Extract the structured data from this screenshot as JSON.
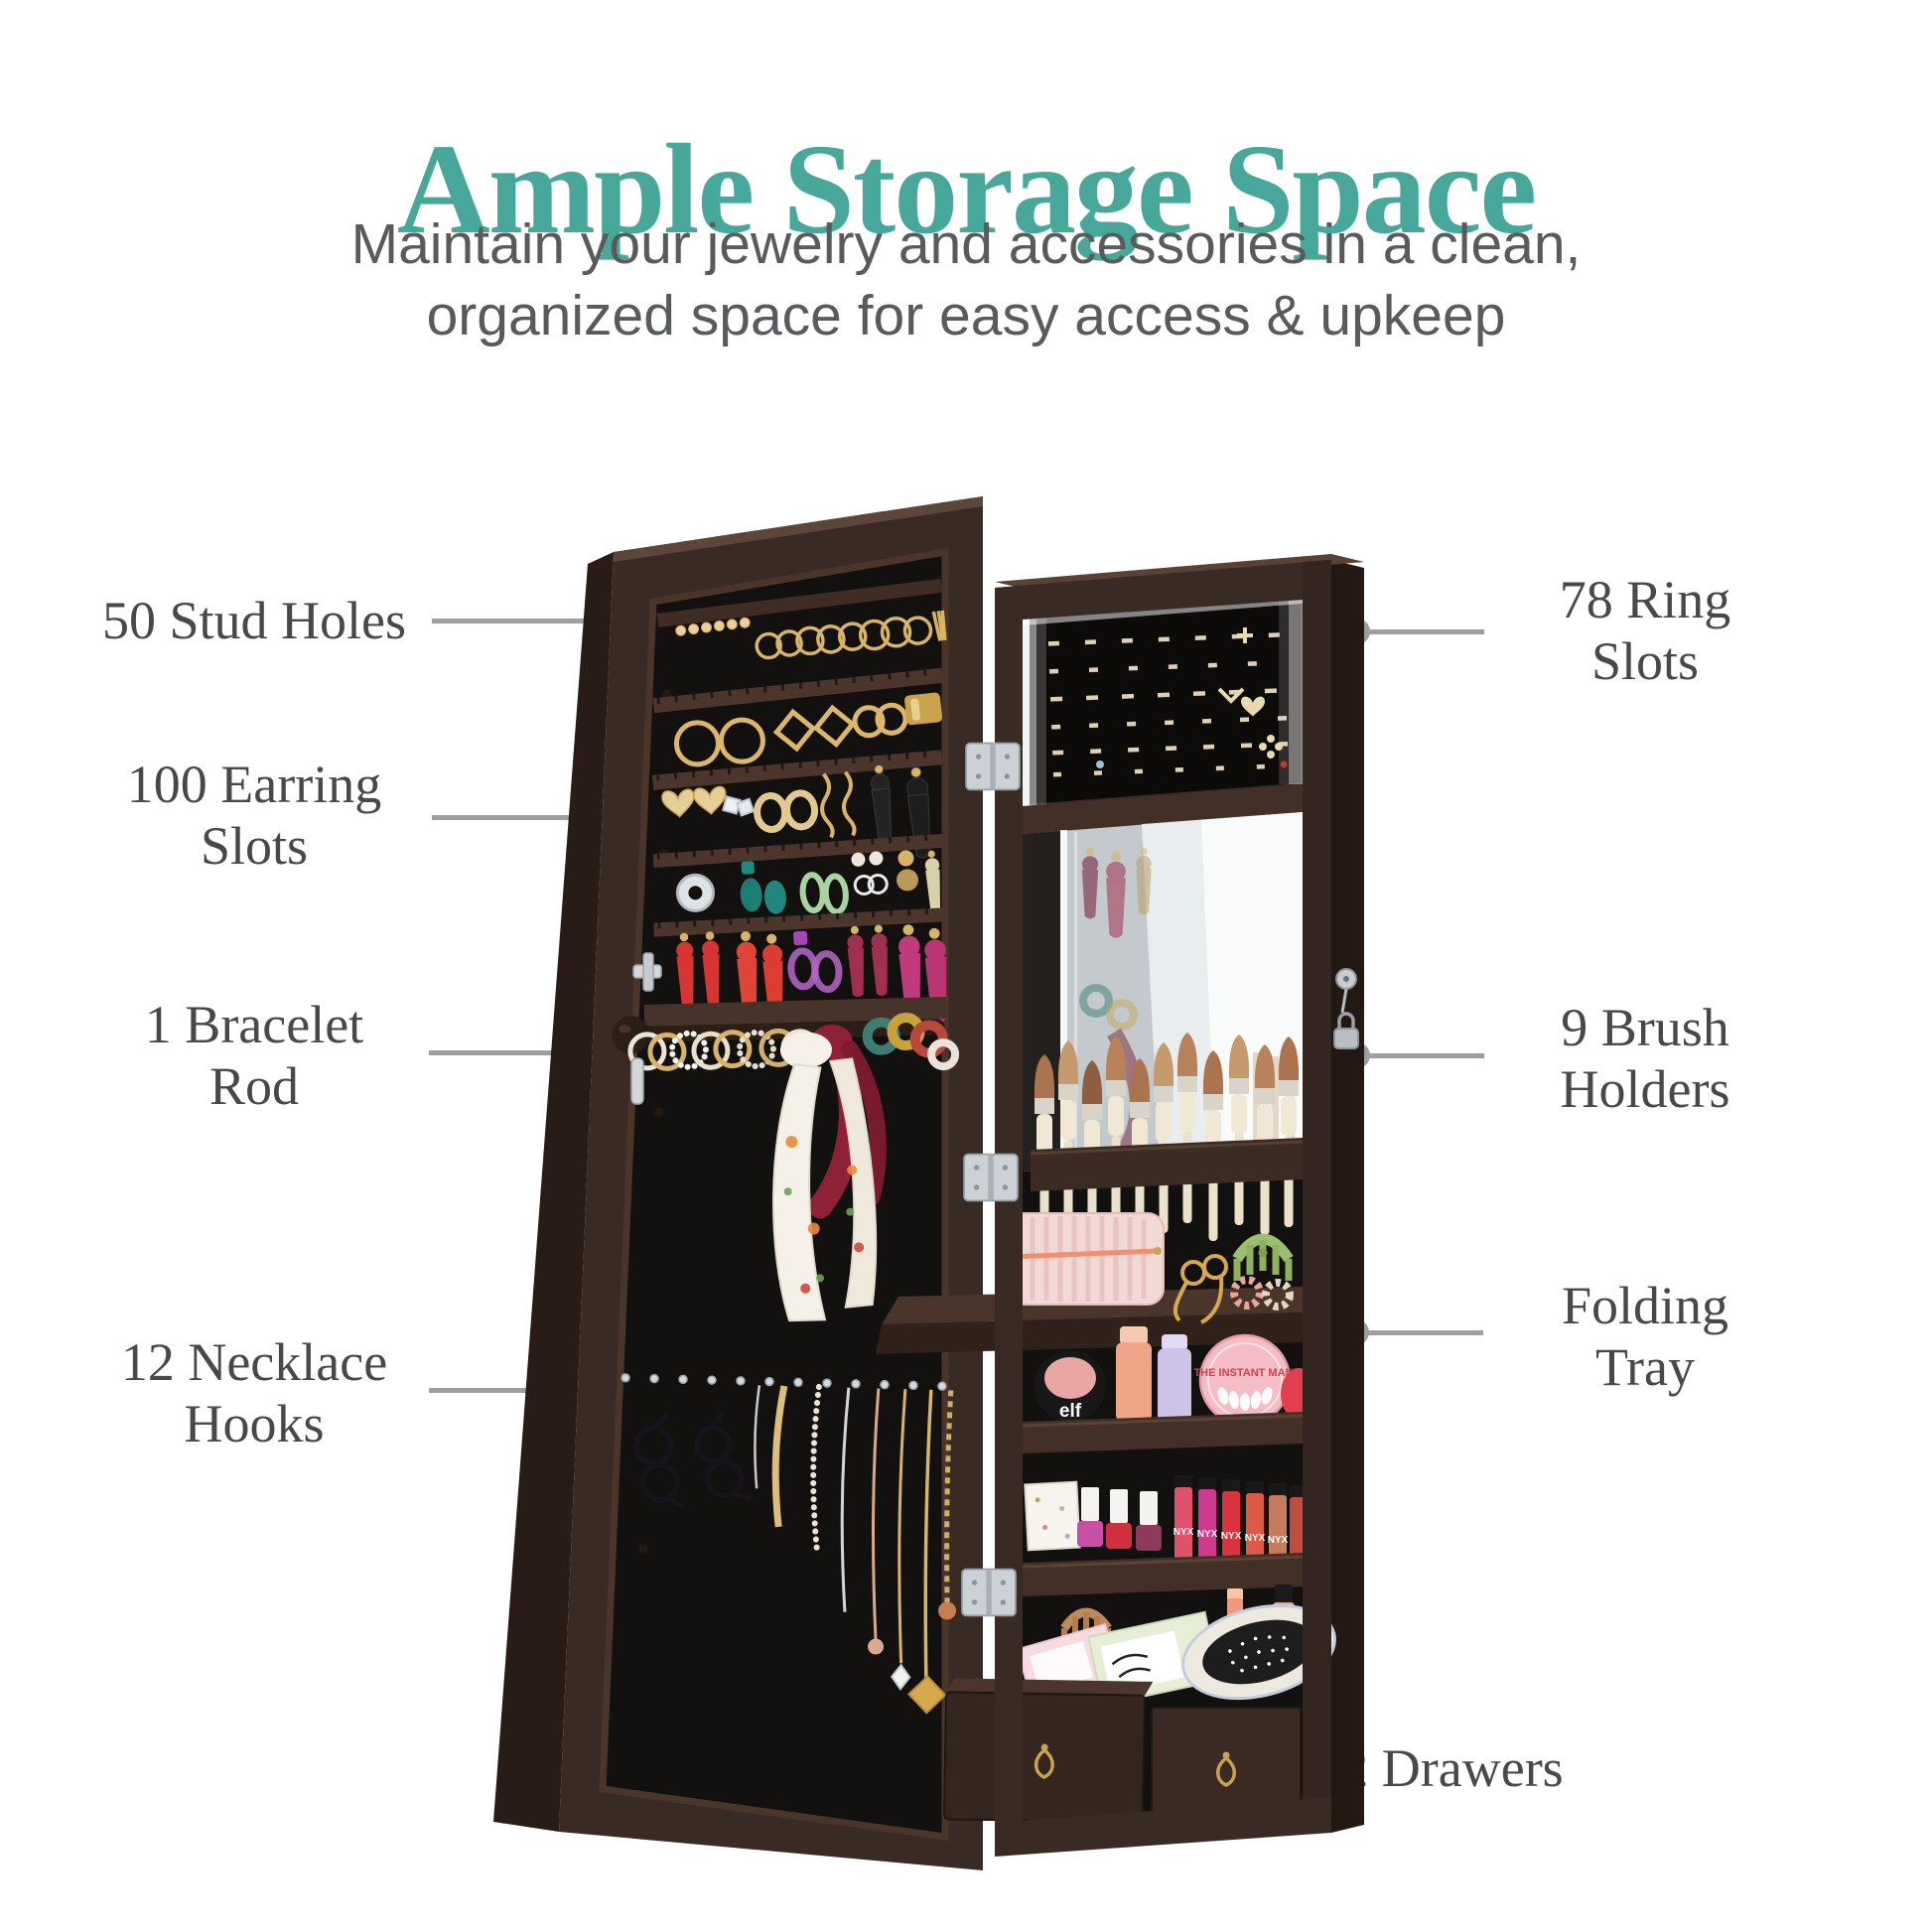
{
  "header": {
    "title": "Ample Storage Space",
    "subtitle_line1": "Maintain your jewelry and accessories in a clean,",
    "subtitle_line2": "organized space for easy access & upkeep"
  },
  "callouts": {
    "left": [
      {
        "line1": "50 Stud Holes",
        "line2": ""
      },
      {
        "line1": "100 Earring",
        "line2": "Slots"
      },
      {
        "line1": "1 Bracelet",
        "line2": "Rod"
      },
      {
        "line1": "12 Necklace",
        "line2": "Hooks"
      }
    ],
    "right": [
      {
        "line1": "78 Ring",
        "line2": "Slots"
      },
      {
        "line1": "9 Brush",
        "line2": "Holders"
      },
      {
        "line1": "Folding",
        "line2": "Tray"
      },
      {
        "line1": "2 Drawers",
        "line2": ""
      }
    ]
  },
  "product": {
    "type": "wall-mounted LED jewelry armoire with mirror, door open showing organizer",
    "labels": {
      "blush": "elf",
      "mani_tin": "THE INSTANT MANI",
      "lipstick_brand": "NYX"
    }
  },
  "colors": {
    "title_teal": "#47a79a",
    "subtitle_gray": "#595a5c",
    "label_gray": "#48484a",
    "connector_gray": "#9d9ea0",
    "cabinet_brown": "#3a2a24",
    "cabinet_dark": "#2a1c16",
    "interior_black": "#131010",
    "rail_brown": "#46332a",
    "gold": "#d9b366",
    "led_white": "#ffffff",
    "mirror_light": "#dde3e5"
  }
}
